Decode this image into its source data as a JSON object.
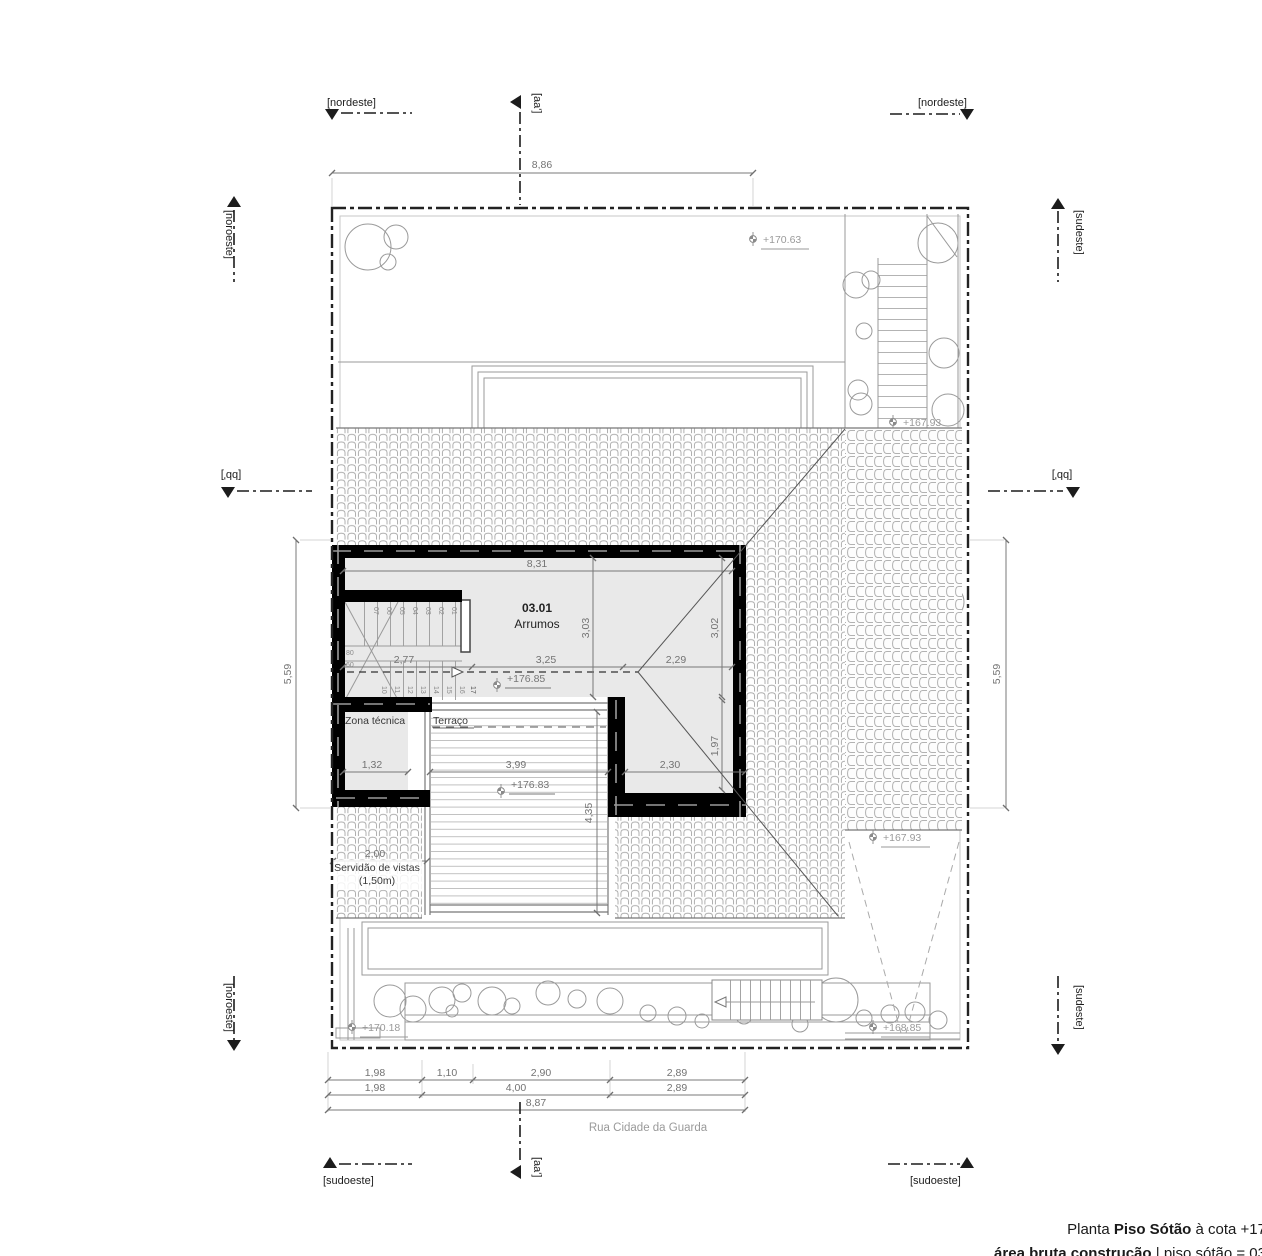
{
  "markers": {
    "nordeste": "[nordeste]",
    "sudoeste": "[sudoeste]",
    "noroeste": "[noroeste]",
    "sudeste": "[sudeste]",
    "aa": "[aa']",
    "bb": "[bb']"
  },
  "dims": {
    "top_width": "8,86",
    "side_height_left": "5,59",
    "side_height_right": "5,59",
    "room_width": "8,31",
    "room_h_mid": "3,03",
    "room_h_right": "3,02",
    "stair_w": "2,77",
    "mid_w": "3,25",
    "right_w": "2,29",
    "zona_w": "1,32",
    "terrace_w": "3,99",
    "terrace_h": "4,35",
    "lower_right_w": "2,30",
    "lower_right_h": "1,97",
    "servidao_w": "2,00",
    "bottom_row1": [
      "1,98",
      "1,10",
      "2,90",
      "2,89"
    ],
    "bottom_row2": [
      "1,98",
      "4,00",
      "2,89"
    ],
    "bottom_total": "8,87"
  },
  "levels": {
    "garden_ne": "+170.63",
    "stairs_e": "+167.93",
    "attic": "+176.85",
    "terrace": "+176.83",
    "roof_se": "+167.93",
    "garden_w": "+170.18",
    "garden_s": "+168.85"
  },
  "room": {
    "number": "03.01",
    "name": "Arrumos"
  },
  "labels": {
    "zona_tecnica": "Zona técnica",
    "terraco": "Terraço",
    "servidao_1": "Servidão de vistas",
    "servidao_2": "(1,50m)",
    "street": "Rua Cidade da Guarda"
  },
  "stair": {
    "upper_treads": [
      "07",
      "06",
      "05",
      "04",
      "03",
      "02",
      "01"
    ],
    "lower_treads": [
      "10",
      "11",
      "12",
      "13",
      "14",
      "15",
      "16"
    ],
    "last_tread": "17",
    "width_a": "80",
    "width_b": "60"
  },
  "title_block": {
    "prefix": "Planta ",
    "name": "Piso Sótão",
    "suffix": " à cota +17",
    "area_label": "área bruta construção ",
    "area_value": "| piso sótão = 03"
  },
  "colors": {
    "wall": "#000000",
    "interior": "#e9e9e9",
    "line": "#9a9a9a",
    "dim": "#787878",
    "level": "#9a9a9a",
    "boundary": "#222222"
  }
}
